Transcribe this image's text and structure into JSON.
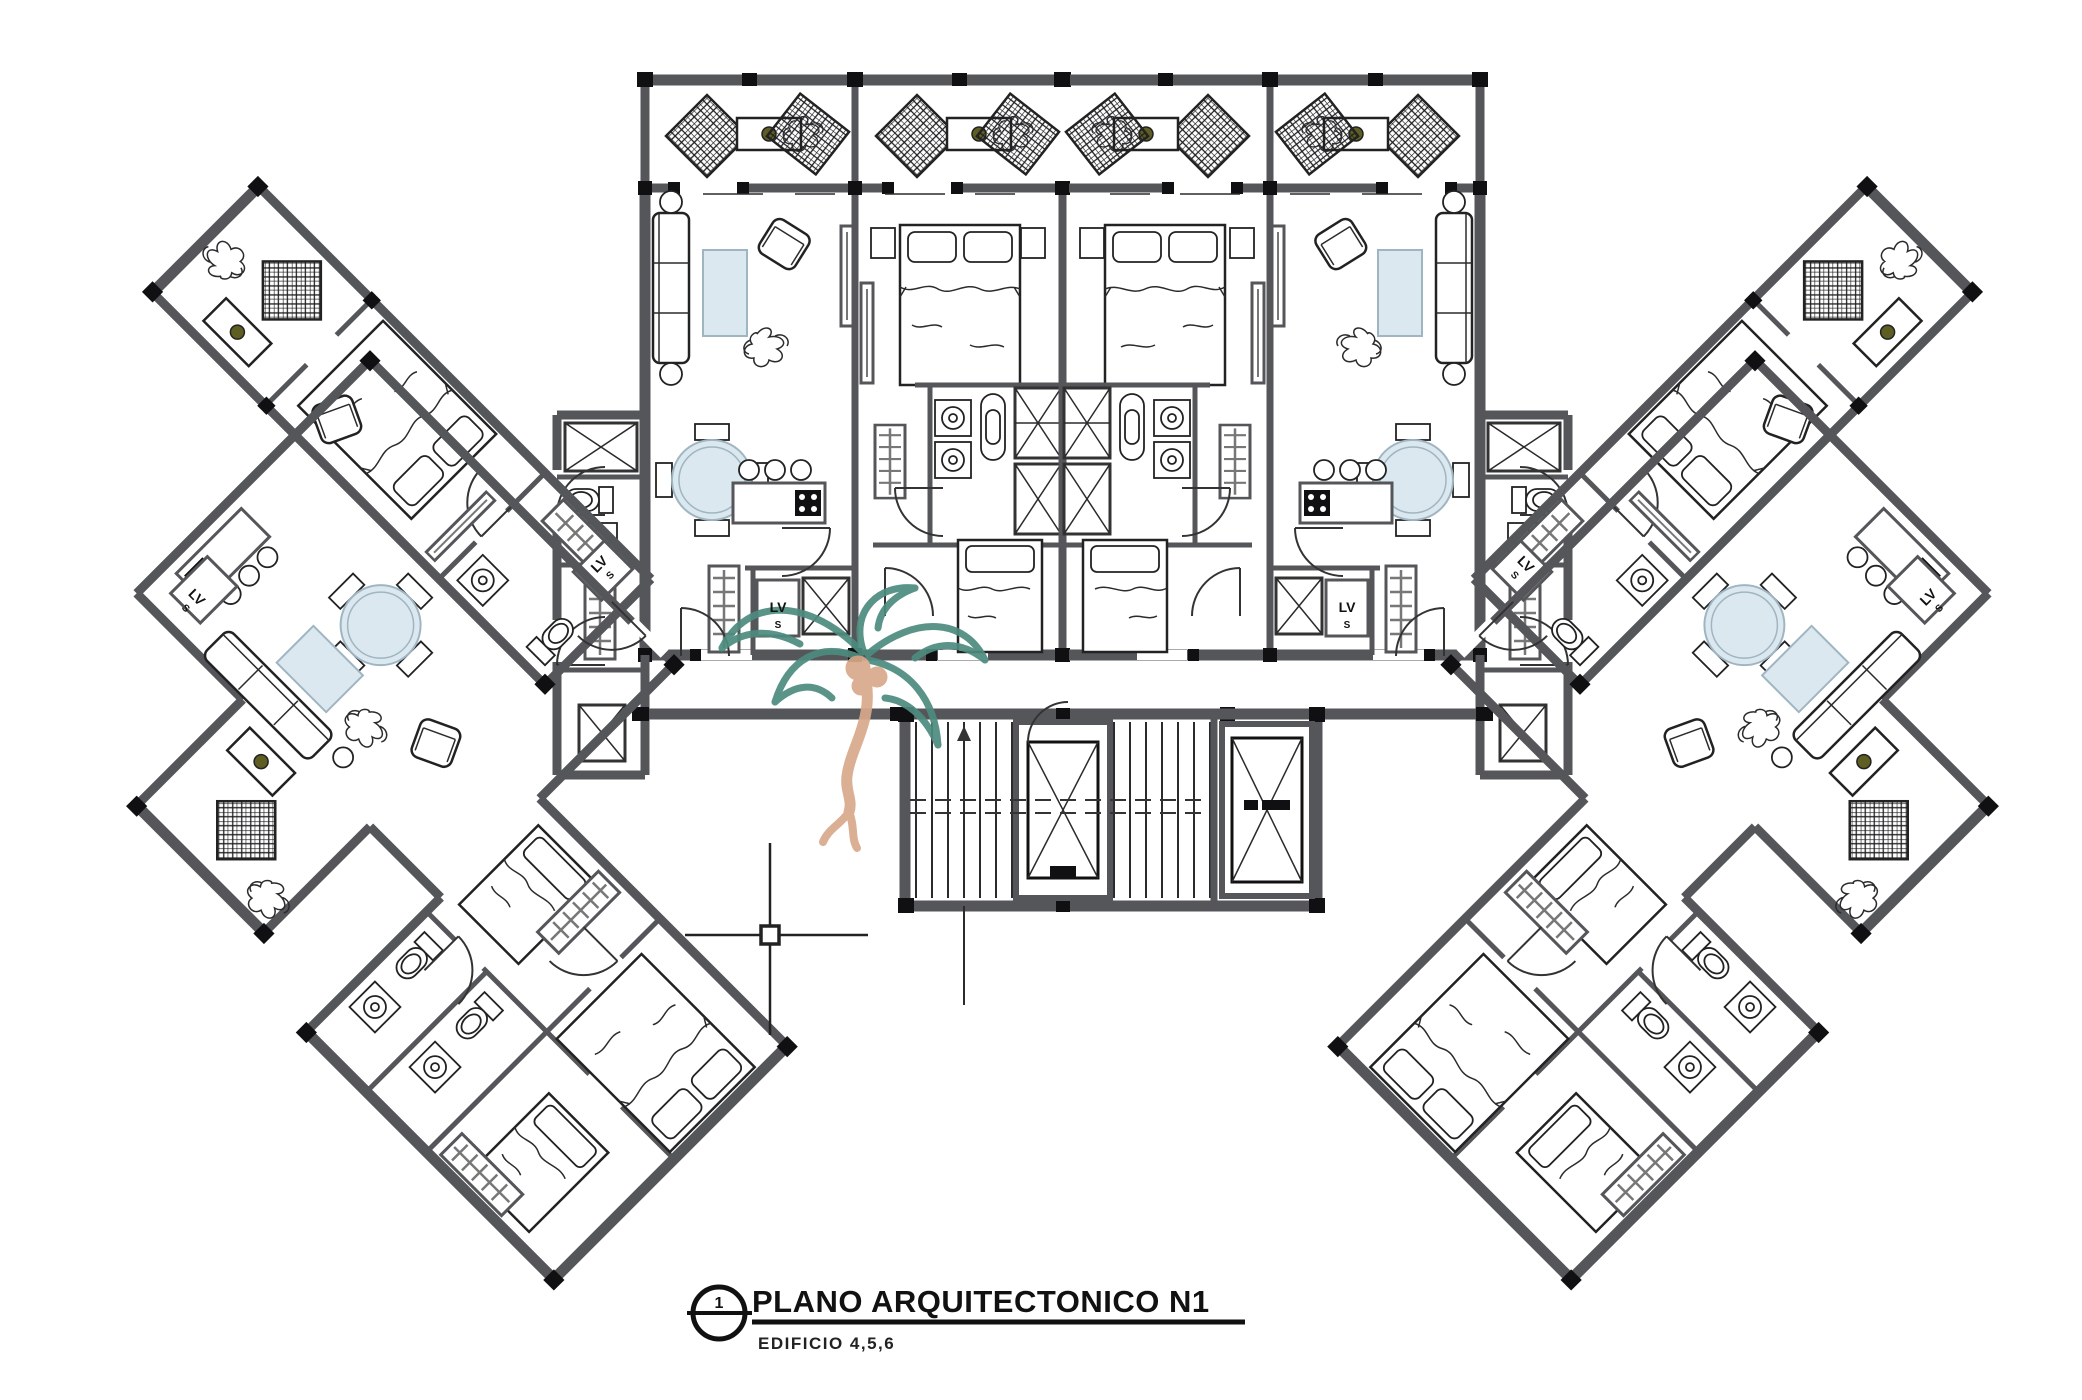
{
  "title_block": {
    "detail_number": "1",
    "title": "PLANO ARQUITECTONICO N1",
    "subtitle": "EDIFICIO 4,5,6"
  },
  "plan_labels": {
    "washer_line1": "LV",
    "washer_line2": "S"
  },
  "icons": {
    "palm": "palm-tree-watermark-icon",
    "crosshair": "cad-crosshair-icon",
    "elevator": "elevator-shaft-x-icon",
    "stairs": "stair-flight-icon"
  },
  "colors": {
    "wall_gray": "#54565A",
    "line_black": "#101012",
    "palm_frond_teal": "#4D8C7F",
    "palm_trunk_tan": "#D9A98A",
    "soft_blue": "#DCE8EF",
    "paper": "#FFFFFF"
  }
}
